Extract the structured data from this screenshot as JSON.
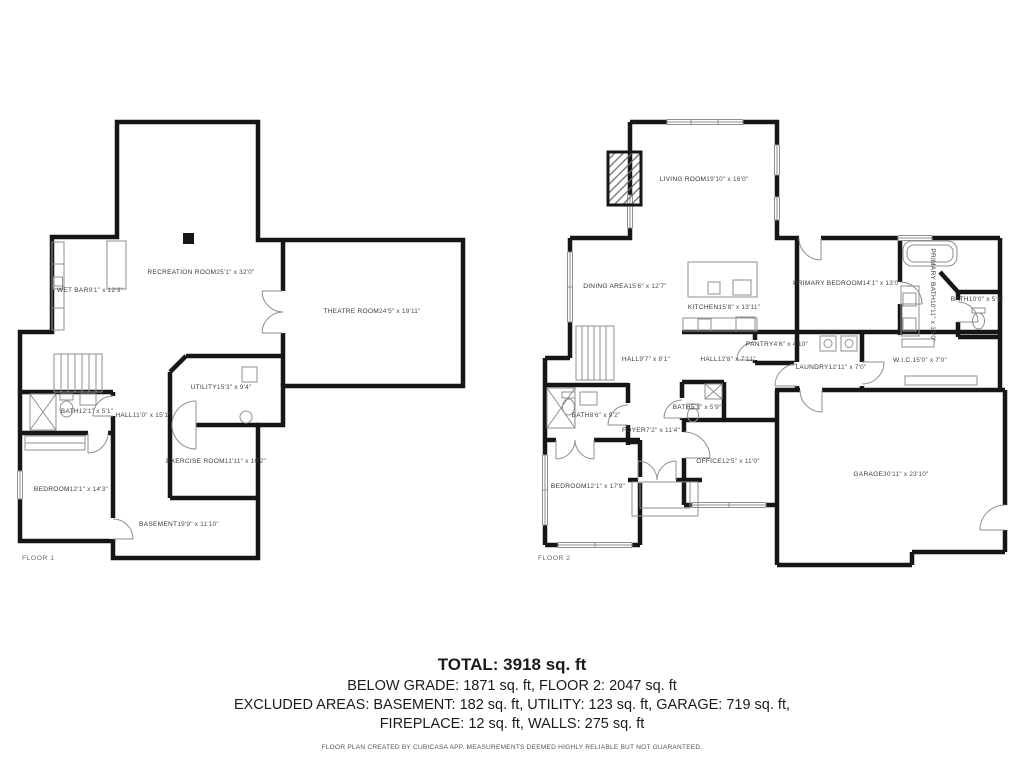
{
  "floor1": {
    "label": "FLOOR 1",
    "rooms": {
      "wet_bar": {
        "name": "WET BAR",
        "dims": "9'1\" x 12'3\""
      },
      "recreation": {
        "name": "RECREATION ROOM",
        "dims": "25'1\" x 32'0\""
      },
      "theatre": {
        "name": "THEATRE ROOM",
        "dims": "24'5\" x 19'11\""
      },
      "utility": {
        "name": "UTILITY",
        "dims": "15'3\" x 9'4\""
      },
      "hall": {
        "name": "HALL",
        "dims": "11'0\" x 15'1\""
      },
      "bath": {
        "name": "BATH",
        "dims": "12'1\" x 5'1\""
      },
      "exercise": {
        "name": "EXERCISE ROOM",
        "dims": "11'11\" x 10'2\""
      },
      "bedroom": {
        "name": "BEDROOM",
        "dims": "12'1\" x 14'3\""
      },
      "basement": {
        "name": "BASEMENT",
        "dims": "19'9\" x 11'10\""
      }
    }
  },
  "floor2": {
    "label": "FLOOR 2",
    "rooms": {
      "living": {
        "name": "LIVING ROOM",
        "dims": "19'10\" x 16'0\""
      },
      "dining": {
        "name": "DINING AREA",
        "dims": "15'6\" x 12'7\""
      },
      "kitchen": {
        "name": "KITCHEN",
        "dims": "15'8\" x 13'11\""
      },
      "pantry": {
        "name": "PANTRY",
        "dims": "4'6\" x 4'10\""
      },
      "primary_bedroom": {
        "name": "PRIMARY BEDROOM",
        "dims": "14'1\" x 13'0\""
      },
      "primary_bath": {
        "name": "PRIMARY BATH",
        "dims": "10'11\" x 13'0\""
      },
      "bath_small": {
        "name": "BATH",
        "dims": "10'0\" x 5'1\""
      },
      "hall_a": {
        "name": "HALL",
        "dims": "9'7\" x 8'1\""
      },
      "hall_b": {
        "name": "HALL",
        "dims": "12'8\" x 7'11\""
      },
      "laundry": {
        "name": "LAUNDRY",
        "dims": "12'11\" x 7'0\""
      },
      "wic": {
        "name": "W.I.C.",
        "dims": "15'0\" x 7'0\""
      },
      "bath2": {
        "name": "BATH",
        "dims": "8'6\" x 9'2\""
      },
      "foyer": {
        "name": "FOYER",
        "dims": "7'2\" x 11'4\""
      },
      "bath3": {
        "name": "BATH",
        "dims": "5'1\" x 5'9\""
      },
      "bedroom2": {
        "name": "BEDROOM",
        "dims": "12'1\" x 17'9\""
      },
      "office": {
        "name": "OFFICE",
        "dims": "12'5\" x 11'0\""
      },
      "garage": {
        "name": "GARAGE",
        "dims": "30'11\" x 23'10\""
      }
    }
  },
  "summary": {
    "total": "TOTAL: 3918 sq. ft",
    "line2": "BELOW GRADE: 1871 sq. ft, FLOOR 2: 2047 sq. ft",
    "line3": "EXCLUDED AREAS: BASEMENT: 182 sq. ft, UTILITY: 123 sq. ft, GARAGE: 719 sq. ft,",
    "line4": "FIREPLACE: 12 sq. ft, WALLS: 275 sq. ft",
    "disclaimer": "FLOOR PLAN CREATED BY CUBICASA APP. MEASUREMENTS DEEMED HIGHLY RELIABLE BUT NOT GUARANTEED."
  },
  "colors": {
    "wall": "#161616",
    "fixture": "#8f8f8f",
    "text": "#3a3a3a"
  }
}
